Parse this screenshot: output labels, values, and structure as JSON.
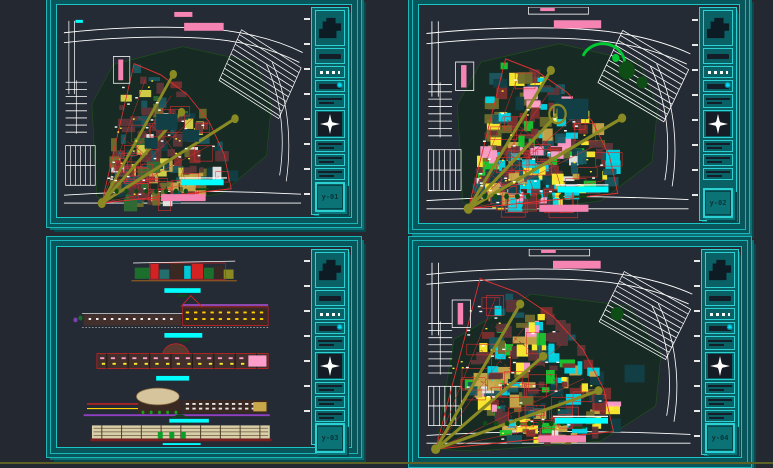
{
  "application": {
    "description": "CAD plot layout view showing four architectural drawing sheets (site plans and elevations) on a dark model-space background",
    "background_color": "#232831",
    "bottom_rule_color": "#5d6125"
  },
  "frame_colors": {
    "teal_dark": "#06565c",
    "teal_bright": "#19b6ba",
    "titleblock_fill": "#0a6165",
    "box_content_dark": "#141e28",
    "sheet_paper": "#252b34"
  },
  "highlight_colors": {
    "pink": "#f584b2",
    "cyan": "#00ffff",
    "white": "#ffffff",
    "green_text": "#0c4a14",
    "red": "#e03030",
    "olive": "#8a8a24",
    "road_white": "#ffffff"
  },
  "plan_colors": {
    "ground_fill": "#0d2a15",
    "ground_stroke": "#1e4d1e",
    "tree_dark_green": "#0f4d16",
    "tree_bright_green": "#00c832",
    "water_teal": "#123f46",
    "block_palette_sparse": [
      [
        "#5e3538",
        26
      ],
      [
        "#7c2f2f",
        10
      ],
      [
        "#1a5660",
        16
      ],
      [
        "#6d6d2c",
        8
      ],
      [
        "#d8d44a",
        10
      ],
      [
        "#e8e8e8",
        4
      ],
      [
        "#2e6b34",
        6
      ],
      [
        "#123f46",
        12
      ],
      [
        "#caa84a",
        8
      ]
    ],
    "block_palette_dense": [
      [
        "#5e3538",
        16
      ],
      [
        "#7c2f2f",
        8
      ],
      [
        "#1a5660",
        12
      ],
      [
        "#6d6d2c",
        7
      ],
      [
        "#ffee30",
        13
      ],
      [
        "#e8e8e8",
        4
      ],
      [
        "#00d8e8",
        10
      ],
      [
        "#ff9ecb",
        8
      ],
      [
        "#18c832",
        5
      ],
      [
        "#123f46",
        9
      ],
      [
        "#caa84a",
        8
      ]
    ],
    "block_palette_fan": [
      [
        "#5e3538",
        20
      ],
      [
        "#7c2f2f",
        9
      ],
      [
        "#1a5660",
        11
      ],
      [
        "#6d6d2c",
        8
      ],
      [
        "#ffee30",
        12
      ],
      [
        "#e8e8e8",
        4
      ],
      [
        "#00d8e8",
        7
      ],
      [
        "#ff9ecb",
        6
      ],
      [
        "#18c832",
        4
      ],
      [
        "#123f46",
        8
      ],
      [
        "#caa84a",
        9
      ]
    ]
  },
  "elevation_colors": {
    "brown_body": "#43302c",
    "dark_brown": "#3a2822",
    "beige": "#d8cfa8",
    "dome_beige": "#d6c49c",
    "maroon_base": "#7a2020",
    "purple_line": "#b052d8",
    "purple_base": "#9040c0",
    "green_body": "#1c6e2c",
    "red_line": "#d42222",
    "yellow": "#ffd400",
    "pink_accent": "#ff9ecb",
    "cyan_accent": "#00c8d8"
  },
  "sheets": [
    {
      "id": "top-left",
      "kind": "site-plan",
      "variant": "sparse",
      "number": "y-01",
      "labels": {
        "top_title_highlight": "pink",
        "bottom_title_highlight": "cyan",
        "bottom_secondary_highlight": "pink",
        "left_margin_highlight": "pink"
      }
    },
    {
      "id": "top-right",
      "kind": "site-plan",
      "variant": "dense",
      "number": "y-02",
      "labels": {
        "top_title_highlight": "pink",
        "bottom_title_highlight": "cyan",
        "bottom_secondary_highlight": "pink",
        "left_margin_highlight": "pink"
      }
    },
    {
      "id": "bottom-left",
      "kind": "elevations",
      "variant": "strips",
      "number": "y-03",
      "labels": {
        "strip_title_highlight": "cyan",
        "strip_count": 5
      }
    },
    {
      "id": "bottom-right",
      "kind": "site-plan",
      "variant": "fan-open",
      "number": "y-04",
      "labels": {
        "top_title_highlight": "pink",
        "bottom_title_highlight": "cyan",
        "bottom_secondary_highlight": "pink",
        "left_margin_highlight": "pink"
      }
    }
  ],
  "titleblock": {
    "boxes": [
      {
        "type": "logo",
        "name": "firm-logo-box",
        "icon": "firm-logo-icon"
      },
      {
        "type": "bar",
        "name": "project-title-box",
        "icon": "dark-bar"
      },
      {
        "type": "dashes",
        "name": "drawing-title-box",
        "icon": "white-dashes-text"
      },
      {
        "type": "barcyan",
        "name": "revision-box",
        "icon": "cyan-star-icon"
      },
      {
        "type": "lines",
        "name": "info-box-1",
        "icon": "dark-lines"
      },
      {
        "type": "north",
        "name": "north-arrow-box",
        "icon": "north-arrow-icon"
      },
      {
        "type": "lines2",
        "name": "info-box-2",
        "icon": "dark-lines"
      },
      {
        "type": "lines2",
        "name": "info-box-3",
        "icon": "dark-lines"
      },
      {
        "type": "lines2",
        "name": "info-box-4",
        "icon": "dark-lines"
      },
      {
        "type": "number",
        "name": "sheet-number-box",
        "icon": "sheet-number"
      }
    ]
  }
}
